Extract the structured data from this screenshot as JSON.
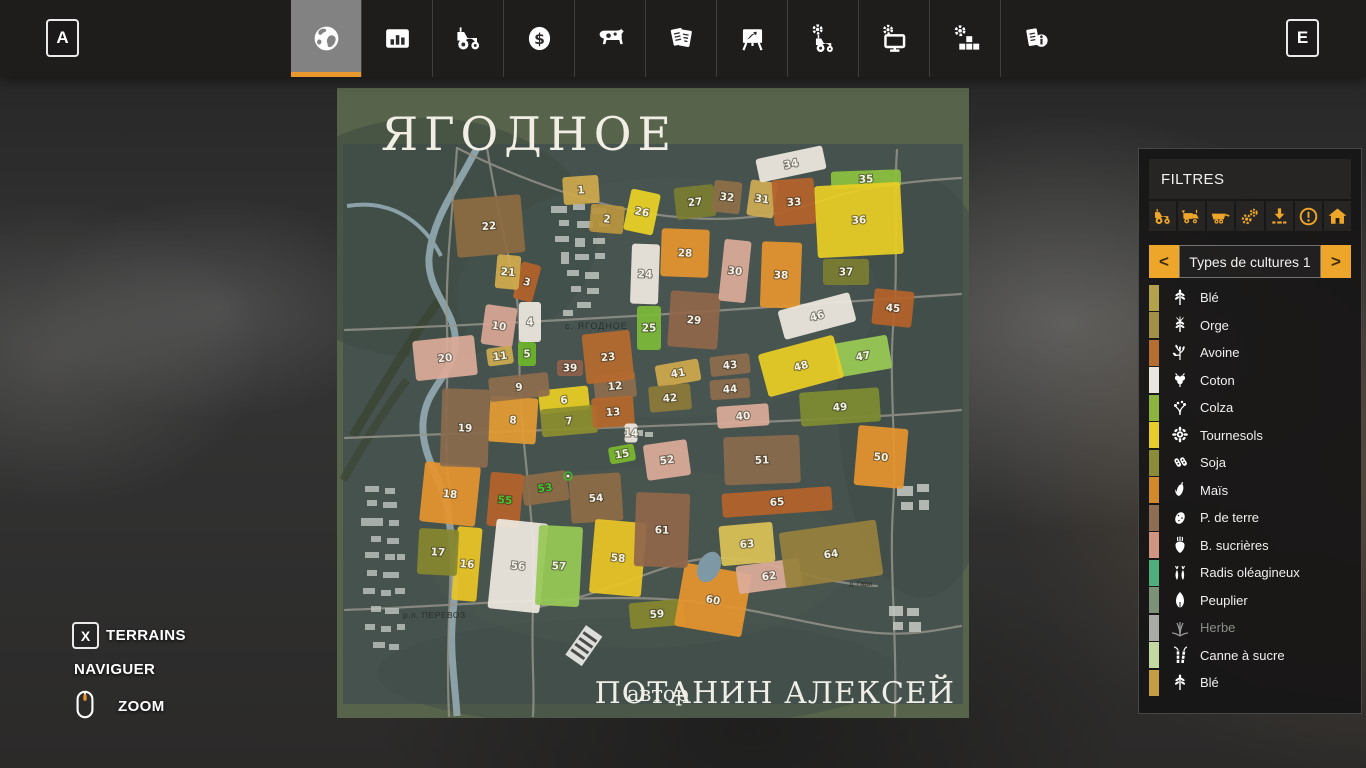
{
  "colors": {
    "accent": "#eda62a",
    "selected_tab": "#828282"
  },
  "topbar": {
    "prev_key": "A",
    "next_key": "E",
    "tabs": [
      {
        "icon": "globe",
        "selected": true
      },
      {
        "icon": "bar-chart",
        "selected": false
      },
      {
        "icon": "tractor",
        "selected": false
      },
      {
        "icon": "dollar",
        "selected": false
      },
      {
        "icon": "cow",
        "selected": false
      },
      {
        "icon": "documents",
        "selected": false
      },
      {
        "icon": "easel",
        "selected": false
      },
      {
        "icon": "tractor-gear",
        "selected": false
      },
      {
        "icon": "monitor-gear",
        "selected": false
      },
      {
        "icon": "gear-blocks",
        "selected": false
      },
      {
        "icon": "documents-info",
        "selected": false
      }
    ]
  },
  "filters": {
    "title": "FILTRES",
    "toggle_icons": [
      "tractor",
      "harvester",
      "trailer",
      "gears",
      "unload",
      "warning",
      "house"
    ],
    "selector": {
      "prev": "<",
      "label": "Types de cultures 1",
      "next": ">"
    },
    "crops": [
      {
        "label": "Blé",
        "color": "#b3a14c",
        "icon": "wheat",
        "disabled": false
      },
      {
        "label": "Orge",
        "color": "#a39048",
        "icon": "barley",
        "disabled": false
      },
      {
        "label": "Avoine",
        "color": "#b56d31",
        "icon": "oat",
        "disabled": false
      },
      {
        "label": "Coton",
        "color": "#e9e5df",
        "icon": "cotton",
        "disabled": false
      },
      {
        "label": "Colza",
        "color": "#8cb43f",
        "icon": "canola",
        "disabled": false
      },
      {
        "label": "Tournesols",
        "color": "#e7cd2b",
        "icon": "sunflower",
        "disabled": false
      },
      {
        "label": "Soja",
        "color": "#8a8c3a",
        "icon": "soy",
        "disabled": false
      },
      {
        "label": "Maïs",
        "color": "#d08a2c",
        "icon": "corn",
        "disabled": false
      },
      {
        "label": "P. de terre",
        "color": "#8d6e55",
        "icon": "potato",
        "disabled": false
      },
      {
        "label": "B. sucrières",
        "color": "#cf9582",
        "icon": "beet",
        "disabled": false
      },
      {
        "label": "Radis oléagineux",
        "color": "#4fae7c",
        "icon": "radish",
        "disabled": false
      },
      {
        "label": "Peuplier",
        "color": "#7d9078",
        "icon": "poplar",
        "disabled": false
      },
      {
        "label": "Herbe",
        "color": "#a9aca6",
        "icon": "grass",
        "disabled": true
      },
      {
        "label": "Canne à sucre",
        "color": "#c3d8a2",
        "icon": "sugarcane",
        "disabled": false
      },
      {
        "label": "Blé",
        "color": "#c59d45",
        "icon": "wheat",
        "disabled": false
      }
    ]
  },
  "controls": {
    "terrains_key": "X",
    "terrains": "TERRAINS",
    "navigate": "NAVIGUER",
    "zoom": "ZOOM"
  },
  "map": {
    "title": "ЯГОДНОЕ",
    "author_label": "автор",
    "author_name": "ПОТАНИН АЛЕКСЕЙ",
    "village_label": "с. ЯГОДНОЕ",
    "town_label": "р.п. ПЕРЕВОЗ",
    "hamlet_label": "д. Гари",
    "fields": [
      {
        "n": 1,
        "x": 244,
        "y": 102,
        "w": 36,
        "h": 28,
        "r": -4,
        "c": "#cfa94e"
      },
      {
        "n": 2,
        "x": 270,
        "y": 131,
        "w": 34,
        "h": 28,
        "r": 5,
        "c": "#b9953f"
      },
      {
        "n": 3,
        "x": 190,
        "y": 194,
        "w": 20,
        "h": 38,
        "r": 15,
        "c": "#b5622a"
      },
      {
        "n": 4,
        "x": 193,
        "y": 234,
        "w": 22,
        "h": 40,
        "r": 0,
        "c": "#eee8e0"
      },
      {
        "n": 5,
        "x": 190,
        "y": 266,
        "w": 18,
        "h": 24,
        "r": 0,
        "c": "#6db52c"
      },
      {
        "n": 6,
        "x": 227,
        "y": 312,
        "w": 50,
        "h": 24,
        "r": -6,
        "c": "#e9cd25"
      },
      {
        "n": 7,
        "x": 232,
        "y": 333,
        "w": 56,
        "h": 28,
        "r": -5,
        "c": "#8b8d2e"
      },
      {
        "n": 8,
        "x": 176,
        "y": 332,
        "w": 48,
        "h": 46,
        "r": 4,
        "c": "#e39b33"
      },
      {
        "n": 9,
        "x": 182,
        "y": 299,
        "w": 60,
        "h": 24,
        "r": -6,
        "c": "#8d6c4c"
      },
      {
        "n": 10,
        "x": 162,
        "y": 238,
        "w": 32,
        "h": 40,
        "r": 8,
        "c": "#d8a694"
      },
      {
        "n": 11,
        "x": 163,
        "y": 268,
        "w": 26,
        "h": 18,
        "r": -8,
        "c": "#cbaa52"
      },
      {
        "n": 12,
        "x": 278,
        "y": 298,
        "w": 42,
        "h": 26,
        "r": -6,
        "c": "#8d6c4c"
      },
      {
        "n": 13,
        "x": 276,
        "y": 324,
        "w": 42,
        "h": 30,
        "r": -4,
        "c": "#b5682c"
      },
      {
        "n": 14,
        "x": 294,
        "y": 345,
        "w": 13,
        "h": 19,
        "r": 0,
        "c": "#eee8e0"
      },
      {
        "n": 15,
        "x": 285,
        "y": 366,
        "w": 26,
        "h": 17,
        "r": -10,
        "c": "#7ab82e"
      },
      {
        "n": 16,
        "x": 130,
        "y": 476,
        "w": 25,
        "h": 74,
        "r": 5,
        "c": "#e9c527"
      },
      {
        "n": 17,
        "x": 101,
        "y": 464,
        "w": 40,
        "h": 46,
        "r": 3,
        "c": "#85862e"
      },
      {
        "n": 18,
        "x": 113,
        "y": 406,
        "w": 56,
        "h": 60,
        "r": 6,
        "c": "#e5942e"
      },
      {
        "n": 19,
        "x": 128,
        "y": 340,
        "w": 48,
        "h": 78,
        "r": 2,
        "c": "#8a6a4e"
      },
      {
        "n": 20,
        "x": 108,
        "y": 270,
        "w": 62,
        "h": 40,
        "r": -6,
        "c": "#dcab99"
      },
      {
        "n": 21,
        "x": 171,
        "y": 184,
        "w": 24,
        "h": 34,
        "r": 5,
        "c": "#d2ab4d"
      },
      {
        "n": 22,
        "x": 152,
        "y": 138,
        "w": 68,
        "h": 58,
        "r": -5,
        "c": "#8d6c42"
      },
      {
        "n": 23,
        "x": 271,
        "y": 269,
        "w": 48,
        "h": 50,
        "r": -6,
        "c": "#b56a2e"
      },
      {
        "n": 24,
        "x": 308,
        "y": 186,
        "w": 28,
        "h": 60,
        "r": 2,
        "c": "#eee8e0"
      },
      {
        "n": 25,
        "x": 312,
        "y": 240,
        "w": 24,
        "h": 44,
        "r": 0,
        "c": "#7cb93a"
      },
      {
        "n": 26,
        "x": 305,
        "y": 124,
        "w": 30,
        "h": 42,
        "r": 12,
        "c": "#e9d226"
      },
      {
        "n": 27,
        "x": 358,
        "y": 114,
        "w": 40,
        "h": 32,
        "r": -6,
        "c": "#7b7d30"
      },
      {
        "n": 28,
        "x": 348,
        "y": 165,
        "w": 48,
        "h": 48,
        "r": 2,
        "c": "#e5942e"
      },
      {
        "n": 29,
        "x": 357,
        "y": 232,
        "w": 50,
        "h": 56,
        "r": 4,
        "c": "#90664a"
      },
      {
        "n": 30,
        "x": 398,
        "y": 183,
        "w": 27,
        "h": 62,
        "r": 6,
        "c": "#dcab99"
      },
      {
        "n": 31,
        "x": 425,
        "y": 111,
        "w": 27,
        "h": 36,
        "r": 8,
        "c": "#ceab55"
      },
      {
        "n": 32,
        "x": 390,
        "y": 109,
        "w": 28,
        "h": 32,
        "r": 6,
        "c": "#8d6f48"
      },
      {
        "n": 33,
        "x": 457,
        "y": 114,
        "w": 42,
        "h": 46,
        "r": -4,
        "c": "#b5622a"
      },
      {
        "n": 34,
        "x": 454,
        "y": 76,
        "w": 68,
        "h": 24,
        "r": -12,
        "c": "#eee8e0"
      },
      {
        "n": 35,
        "x": 529,
        "y": 91,
        "w": 70,
        "h": 17,
        "r": -2,
        "c": "#8cc03e"
      },
      {
        "n": 36,
        "x": 522,
        "y": 132,
        "w": 86,
        "h": 72,
        "r": -3,
        "c": "#e9cd25"
      },
      {
        "n": 37,
        "x": 509,
        "y": 184,
        "w": 46,
        "h": 26,
        "r": 0,
        "c": "#7b7d30"
      },
      {
        "n": 38,
        "x": 444,
        "y": 187,
        "w": 40,
        "h": 66,
        "r": 2,
        "c": "#e5942e"
      },
      {
        "n": 39,
        "x": 233,
        "y": 280,
        "w": 26,
        "h": 16,
        "r": 0,
        "c": "#8d604a"
      },
      {
        "n": 40,
        "x": 406,
        "y": 328,
        "w": 52,
        "h": 22,
        "r": -4,
        "c": "#dcab99"
      },
      {
        "n": 41,
        "x": 341,
        "y": 285,
        "w": 44,
        "h": 22,
        "r": -10,
        "c": "#cfa94e"
      },
      {
        "n": 42,
        "x": 333,
        "y": 310,
        "w": 42,
        "h": 26,
        "r": -5,
        "c": "#8d7a3a"
      },
      {
        "n": 43,
        "x": 393,
        "y": 277,
        "w": 40,
        "h": 20,
        "r": -6,
        "c": "#8d6c4c"
      },
      {
        "n": 44,
        "x": 393,
        "y": 301,
        "w": 40,
        "h": 20,
        "r": -4,
        "c": "#8d6c4c"
      },
      {
        "n": 45,
        "x": 556,
        "y": 220,
        "w": 40,
        "h": 36,
        "r": 6,
        "c": "#b5622a"
      },
      {
        "n": 46,
        "x": 480,
        "y": 228,
        "w": 74,
        "h": 30,
        "r": -15,
        "c": "#eee8e0"
      },
      {
        "n": 47,
        "x": 526,
        "y": 268,
        "w": 54,
        "h": 34,
        "r": -10,
        "c": "#9aca54"
      },
      {
        "n": 48,
        "x": 464,
        "y": 278,
        "w": 78,
        "h": 44,
        "r": -15,
        "c": "#e9cd25"
      },
      {
        "n": 49,
        "x": 503,
        "y": 319,
        "w": 80,
        "h": 34,
        "r": -4,
        "c": "#7f8c32"
      },
      {
        "n": 50,
        "x": 544,
        "y": 369,
        "w": 50,
        "h": 60,
        "r": 5,
        "c": "#e5942e"
      },
      {
        "n": 51,
        "x": 425,
        "y": 372,
        "w": 76,
        "h": 48,
        "r": -2,
        "c": "#8a6a4e"
      },
      {
        "n": 52,
        "x": 330,
        "y": 372,
        "w": 44,
        "h": 36,
        "r": -8,
        "c": "#dcab99"
      },
      {
        "n": 53,
        "x": 208,
        "y": 400,
        "w": 46,
        "h": 30,
        "r": -8,
        "c": "#8d6c46",
        "nc": "#3ec82e"
      },
      {
        "n": 54,
        "x": 259,
        "y": 410,
        "w": 52,
        "h": 48,
        "r": -4,
        "c": "#8d6c46"
      },
      {
        "n": 55,
        "x": 168,
        "y": 412,
        "w": 33,
        "h": 54,
        "r": 5,
        "c": "#b5622a",
        "nc": "#3ec82e"
      },
      {
        "n": 56,
        "x": 181,
        "y": 478,
        "w": 52,
        "h": 90,
        "r": 6,
        "c": "#eee8e0"
      },
      {
        "n": 57,
        "x": 222,
        "y": 478,
        "w": 44,
        "h": 80,
        "r": 3,
        "c": "#97c855"
      },
      {
        "n": 58,
        "x": 281,
        "y": 470,
        "w": 52,
        "h": 74,
        "r": 5,
        "c": "#e9c527"
      },
      {
        "n": 59,
        "x": 320,
        "y": 526,
        "w": 55,
        "h": 26,
        "r": -5,
        "c": "#85862e"
      },
      {
        "n": 60,
        "x": 376,
        "y": 512,
        "w": 68,
        "h": 64,
        "r": 10,
        "c": "#e5942e"
      },
      {
        "n": 61,
        "x": 325,
        "y": 442,
        "w": 54,
        "h": 74,
        "r": 2,
        "c": "#90664a"
      },
      {
        "n": 62,
        "x": 432,
        "y": 488,
        "w": 64,
        "h": 28,
        "r": -8,
        "c": "#dcab99"
      },
      {
        "n": 63,
        "x": 410,
        "y": 456,
        "w": 54,
        "h": 40,
        "r": -5,
        "c": "#d9c257"
      },
      {
        "n": 64,
        "x": 494,
        "y": 466,
        "w": 98,
        "h": 56,
        "r": -8,
        "c": "#97803c"
      },
      {
        "n": 65,
        "x": 440,
        "y": 414,
        "w": 110,
        "h": 24,
        "r": -4,
        "c": "#b5622a"
      }
    ]
  }
}
